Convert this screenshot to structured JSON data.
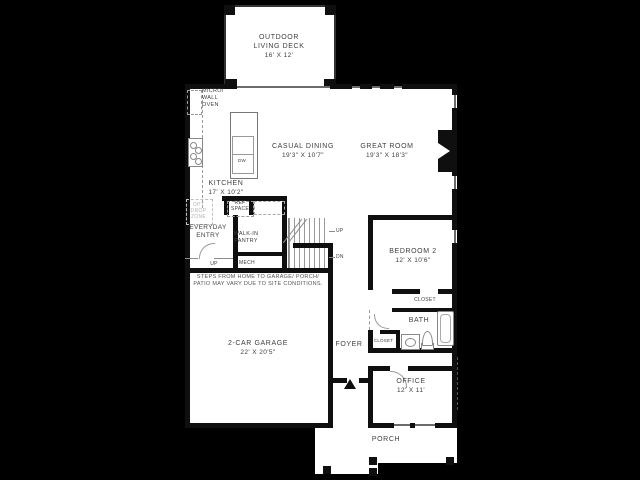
{
  "plan": {
    "deck": {
      "name": "OUTDOOR\nLIVING DECK",
      "dims": "16' X 12'"
    },
    "casual_dining": {
      "name": "CASUAL DINING",
      "dims": "19'3\" X 10'7\""
    },
    "great_room": {
      "name": "GREAT ROOM",
      "dims": "19'3\" X 18'3\""
    },
    "kitchen": {
      "name": "KITCHEN",
      "dims": "17' X 10'2\""
    },
    "garage": {
      "name": "2-CAR GARAGE",
      "dims": "22' X 20'5\""
    },
    "bedroom2": {
      "name": "BEDROOM 2",
      "dims": "12' X 10'6\""
    },
    "office": {
      "name": "OFFICE",
      "dims": "12' X 11'"
    },
    "everyday_entry": {
      "name": "EVERYDAY\nENTRY"
    },
    "walk_in_pantry": {
      "name": "WALK-IN\nPANTRY"
    },
    "micro_wall_oven": {
      "name": "MICRO/\nWALL\nOVEN"
    },
    "opt_drop_zone": {
      "name": "OPT\nDROP\nZONE"
    },
    "ref_space": {
      "name": "REF\nSPACE"
    },
    "mech": {
      "name": "MECH"
    },
    "foyer": {
      "name": "FOYER"
    },
    "bath": {
      "name": "BATH"
    },
    "porch": {
      "name": "PORCH"
    },
    "closet_bedroom": {
      "name": "CLOSET"
    },
    "closet_foyer": {
      "name": "CLOSET"
    },
    "dw": {
      "name": "DW"
    },
    "stairs": {
      "up": "UP",
      "dn": "DN"
    },
    "entry_up": "UP",
    "disclaimer": "STEPS FROM HOME TO GARAGE/ PORCH/\nPATIO MAY VARY DUE TO SITE CONDITIONS."
  },
  "colors": {
    "background": "#000000",
    "floor": "#ffffff",
    "wall": "#0f0f0f",
    "thin_line": "#8c8c8c",
    "text": "#3f3f3f"
  }
}
